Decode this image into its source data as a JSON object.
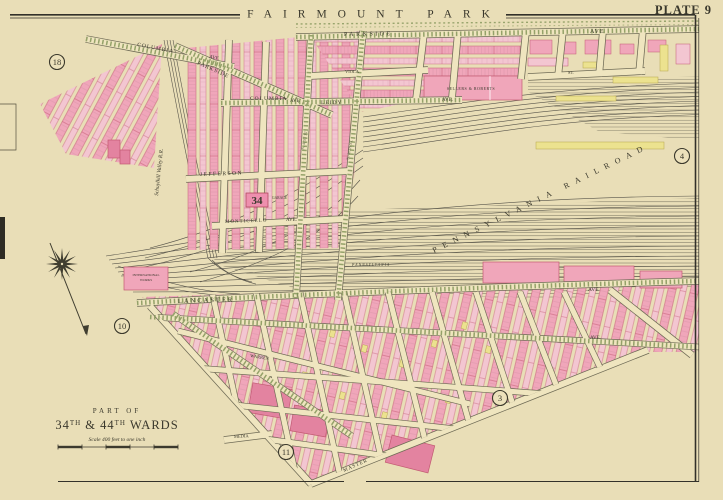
{
  "map_meta": {
    "park": "FAIRMOUNT PARK",
    "plate": "PLATE 9"
  },
  "plate_refs": {
    "r18": "18",
    "r4": "4",
    "r10": "10",
    "r3": "3",
    "r11": "11"
  },
  "ward_badge": "34",
  "title_block": {
    "part_of": "PART OF",
    "wards_num1": "34",
    "wards_sup1": "TH",
    "wards_mid": " & 44",
    "wards_sup2": "TH",
    "wards_end": " WARDS",
    "scale_note": "Scale 400 feet to one inch"
  },
  "railroad": {
    "yard": "PENNSYLVANIA RAILROAD",
    "valley": "Schuylkill Valley R.R.",
    "penna": "PENNSYLVANIA"
  },
  "streets": {
    "parkside": "PARKSIDE",
    "parkside_ave": "AVE",
    "columbia_nw": "COLUMBIA",
    "columbia_nw_ave": "AVE",
    "parkside_diag": "PARKSIDE",
    "columbia_mid": "COLUMBIA",
    "columbia_mid_ave": "AVE",
    "leidy": "LEIDY",
    "leidy_ave": "AVE.",
    "viola": "VIOLA",
    "jefferson": "JEFFERSON",
    "monticello": "MONTICELLO",
    "monticello_ave": "AVE.",
    "lancaster": "LANCASTER",
    "lancaster_ave": "AVE",
    "westminster_ave": "AVE.",
    "master": "MASTER",
    "media": "MEDIA",
    "warren": "WARREN",
    "st_top_right": "ST.",
    "n41": "N. 41ST ST.",
    "n40": "N. 40TH ST."
  },
  "buildings": {
    "factory": "SELLERS & ROBERTS",
    "garage": "GARAGE",
    "works_1": "INTERNATIONAL",
    "works_2": "WORKS"
  },
  "colors": {
    "paper": "#e9deb7",
    "pink": "#f0a6ba",
    "pink_pale": "#f3c6d1",
    "pink_deep": "#e383a0",
    "red": "#c25b72",
    "yellow": "#ece28f",
    "green": "#7e9154",
    "ink": "#35332a",
    "rail": "#57544a"
  }
}
